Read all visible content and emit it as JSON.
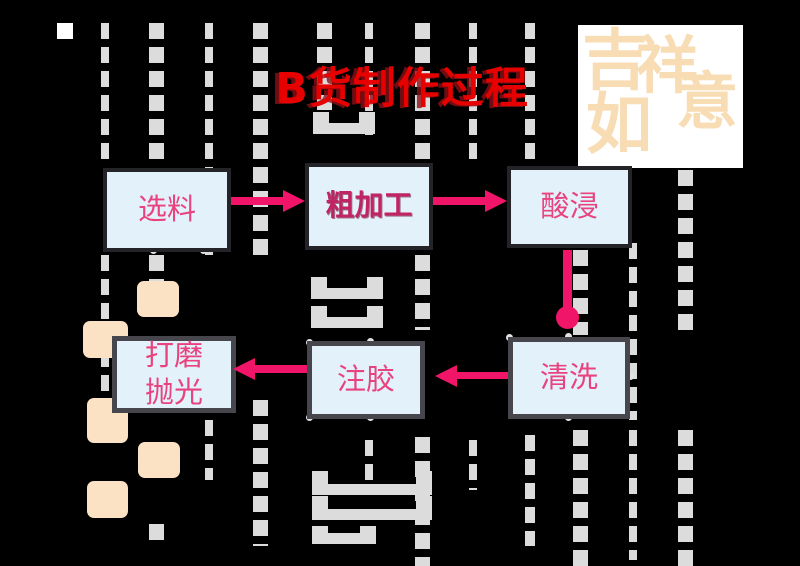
{
  "title": {
    "text": "B货制作过程",
    "color": "#e60000"
  },
  "stamp": {
    "text": "吉祥如意",
    "chars": [
      "吉",
      "祥",
      "如",
      "意"
    ],
    "ink_color": "#f8dcb4",
    "paper_color": "#ffffff"
  },
  "flowchart": {
    "nodes": [
      {
        "id": "select-material",
        "label": "选料"
      },
      {
        "id": "rough-processing",
        "label": "粗加工",
        "emphasis": true
      },
      {
        "id": "acid-soak",
        "label": "酸浸"
      },
      {
        "id": "cleaning",
        "label": "清洗"
      },
      {
        "id": "glue-injection",
        "label": "注胶"
      },
      {
        "id": "grind-polish",
        "label": "打磨\n抛光"
      }
    ],
    "edges": [
      {
        "from": "选料",
        "to": "粗加工",
        "direction": "right"
      },
      {
        "from": "粗加工",
        "to": "酸浸",
        "direction": "right"
      },
      {
        "from": "酸浸",
        "to": "清洗",
        "direction": "down"
      },
      {
        "from": "清洗",
        "to": "注胶",
        "direction": "left"
      },
      {
        "from": "注胶",
        "to": "打磨抛光",
        "direction": "left"
      }
    ],
    "box_fill": "#e3f1fa",
    "box_border_dark": "#232328",
    "box_border_gray": "#46464c",
    "label_color": "#e8437f",
    "emphasis_label_color": "#c12463",
    "arrow_color": "#f01568"
  },
  "background": {
    "color": "#000000",
    "dash_color": "#dcdcdc",
    "accent_square_color": "#ffffff",
    "peach_square_color": "#fce2c4"
  }
}
